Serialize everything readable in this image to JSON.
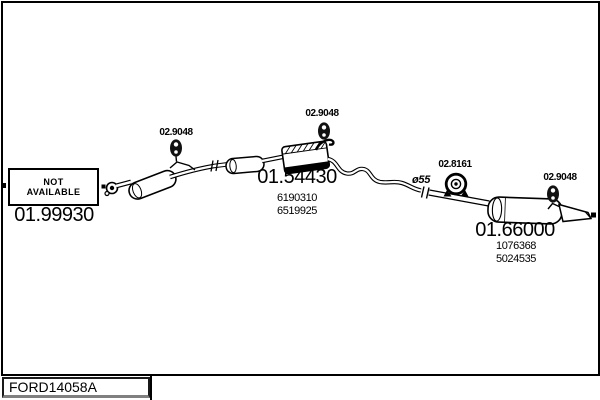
{
  "diagram": {
    "code": "FORD14058A",
    "not_available": {
      "line1": "NOT",
      "line2": "AVAILABLE"
    },
    "parts": [
      {
        "id": "front-pipe",
        "number": "01.99930",
        "oe_numbers": []
      },
      {
        "id": "centre-silencer",
        "number": "01.54430",
        "oe_numbers": [
          "6190310",
          "6519925"
        ]
      },
      {
        "id": "rear-silencer",
        "number": "01.66000",
        "oe_numbers": [
          "1076368",
          "5024535"
        ]
      }
    ],
    "accessories": [
      {
        "id": "front-hanger",
        "number": "02.9048"
      },
      {
        "id": "centre-hanger",
        "number": "02.9048"
      },
      {
        "id": "clamp",
        "number": "02.8161"
      },
      {
        "id": "rear-hanger",
        "number": "02.9048"
      }
    ],
    "annotations": {
      "pipe_diameter": "ø55"
    },
    "colors": {
      "line": "#000000",
      "background": "#ffffff"
    }
  }
}
